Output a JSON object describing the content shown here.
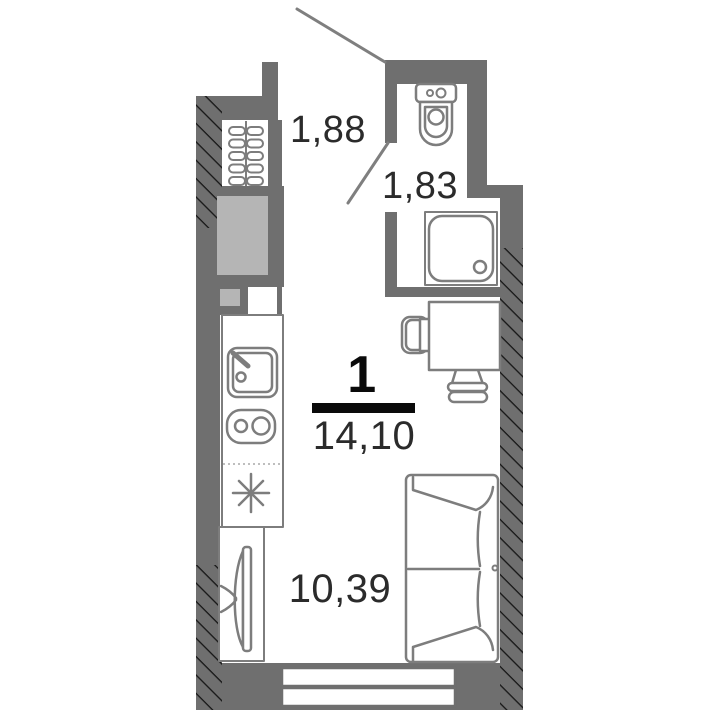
{
  "plan": {
    "legend": {
      "rooms_count": "1",
      "total_area": "14,10"
    },
    "areas": {
      "hallway": "1,88",
      "bathroom": "1,83",
      "living_room": "10,39"
    },
    "fixtures": [
      "toilet",
      "shower-tray",
      "radiator",
      "vent-shaft",
      "kitchen-counter",
      "kitchen-sink",
      "stove",
      "fridge",
      "tv",
      "tv-cabinet",
      "desk",
      "chair",
      "stool",
      "sofa",
      "window",
      "entry-door",
      "bathroom-door"
    ],
    "colors": {
      "wall": "#6f6f6f",
      "shaft": "#b5b5b5",
      "fixture": "#7d7d7d",
      "hatch_line": "#161616",
      "text": "#2b2b2b",
      "accent": "#0a0a0a",
      "door": "#7f7f7f",
      "bg": "#ffffff"
    }
  }
}
